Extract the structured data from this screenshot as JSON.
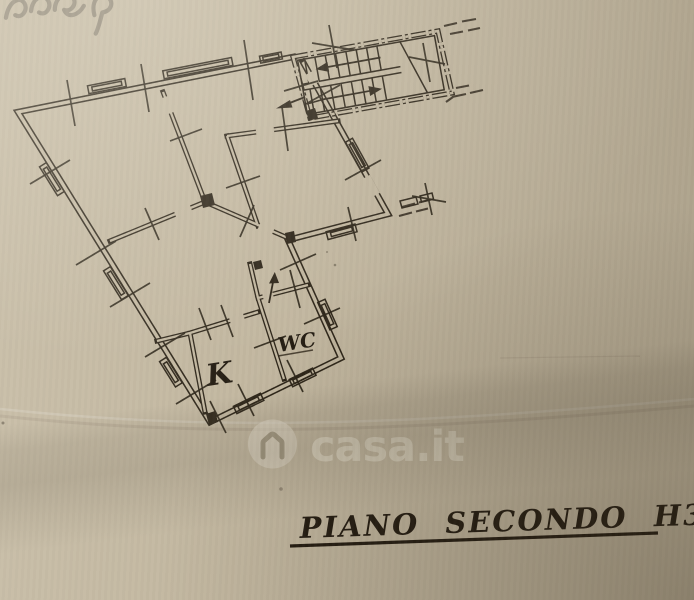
{
  "colors": {
    "paper": "#c2b7a0",
    "ink": "#2e2619",
    "pencil": "#837b6b",
    "watermark_text": "#ded6c3"
  },
  "floor_plan": {
    "room_labels": {
      "kitchen": "K",
      "wc": "WC"
    },
    "caption": "PIANO SECONDO H3.00"
  },
  "watermark": {
    "brand": "casa.it"
  }
}
